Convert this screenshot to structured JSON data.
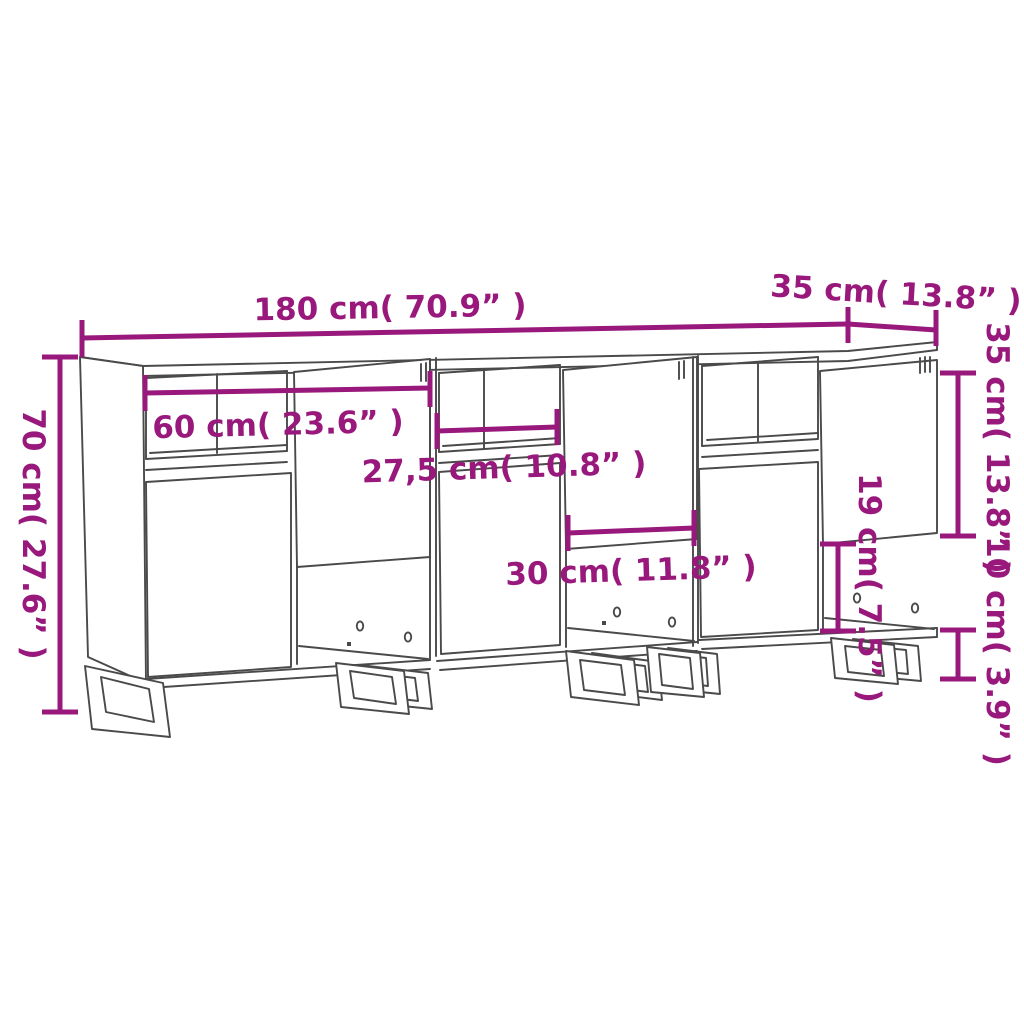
{
  "page": {
    "title": "Sideboard dimension diagram"
  },
  "colors": {
    "dimension": "#98187C",
    "outline": "#4A4A4A",
    "background": "#FFFFFF"
  },
  "dimensions": {
    "total_width": {
      "cm": "180",
      "inch": "70.9",
      "label": "180 cm( 70.9” )"
    },
    "top_depth": {
      "cm": "35",
      "inch": "13.8",
      "label": "35 cm( 13.8” )"
    },
    "total_height": {
      "cm": "70",
      "inch": "27.6",
      "label": "70 cm( 27.6” )"
    },
    "interior_width": {
      "cm": "60",
      "inch": "23.6",
      "label": "60 cm( 23.6” )"
    },
    "shelf_width": {
      "cm": "27,5",
      "inch": "10.8",
      "label": "27,5 cm( 10.8” )"
    },
    "opening_width": {
      "cm": "30",
      "inch": "11.8",
      "label": "30 cm( 11.8” )"
    },
    "opening_height": {
      "cm": "19",
      "inch": "7.5",
      "label": "19 cm( 7.5” )"
    },
    "door_height": {
      "cm": "35",
      "inch": "13.8",
      "label": "35 cm( 13.8” )"
    },
    "leg_height": {
      "cm": "10",
      "inch": "3.9",
      "label": "10 cm( 3.9” )"
    }
  }
}
